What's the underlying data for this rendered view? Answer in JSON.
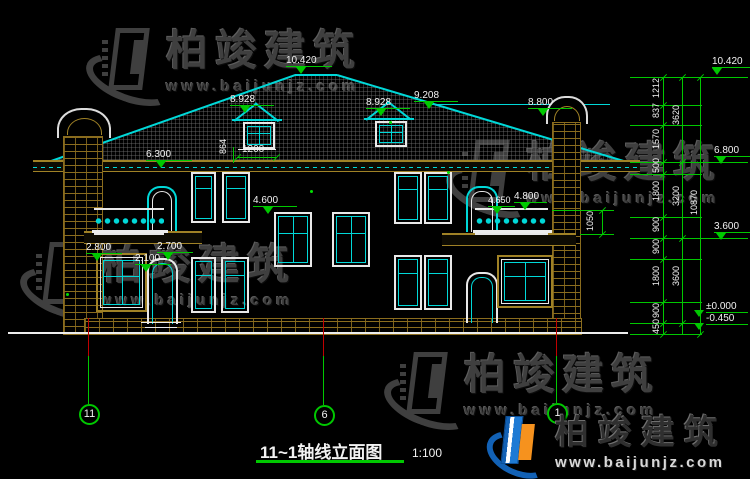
{
  "watermark": {
    "brand": "柏竣建筑",
    "url": "www.baijunjz.com"
  },
  "logo": {
    "brand": "柏竣建筑",
    "url": "www.baijunjz.com"
  },
  "title_block": {
    "title": "11~1轴线立面图",
    "scale": "1:100"
  },
  "axes": {
    "left": "11",
    "middle": "6",
    "right": "1"
  },
  "elevations": {
    "ridge": "10.420",
    "dormer_left": "8.928",
    "dormer_right": "8.928",
    "roof_break": "9.208",
    "chimney_right": "8.800",
    "eave_left": "6.300",
    "window_head_2f": "4.600",
    "balcony_right_low": "4.650",
    "balcony_right_high": "4.800",
    "porch_left": "2.800",
    "porch_right": "2.700",
    "door_head_1f": "2.100",
    "chain_top": "10.420",
    "chain_upper": "6.800",
    "chain_mid": "3.600",
    "chain_zero": "±0.000",
    "chain_ground": "-0.450"
  },
  "dimensions": {
    "dormer_width": "1200",
    "dormer_height": "864",
    "railing_height": "1050",
    "chain_segments": [
      "1212",
      "837",
      "1570",
      "500",
      "1800",
      "900",
      "900",
      "1800",
      "900",
      "450"
    ],
    "chain_groups": [
      "3620",
      "3200",
      "3600"
    ],
    "chain_total": "10870"
  },
  "colors": {
    "line_cyan": "#00d8d8",
    "dim_green": "#00c800",
    "brick_tan": "#a08226",
    "axis_red": "#c00000",
    "logo_blue": "#1261b5",
    "logo_orange": "#f6921e"
  }
}
